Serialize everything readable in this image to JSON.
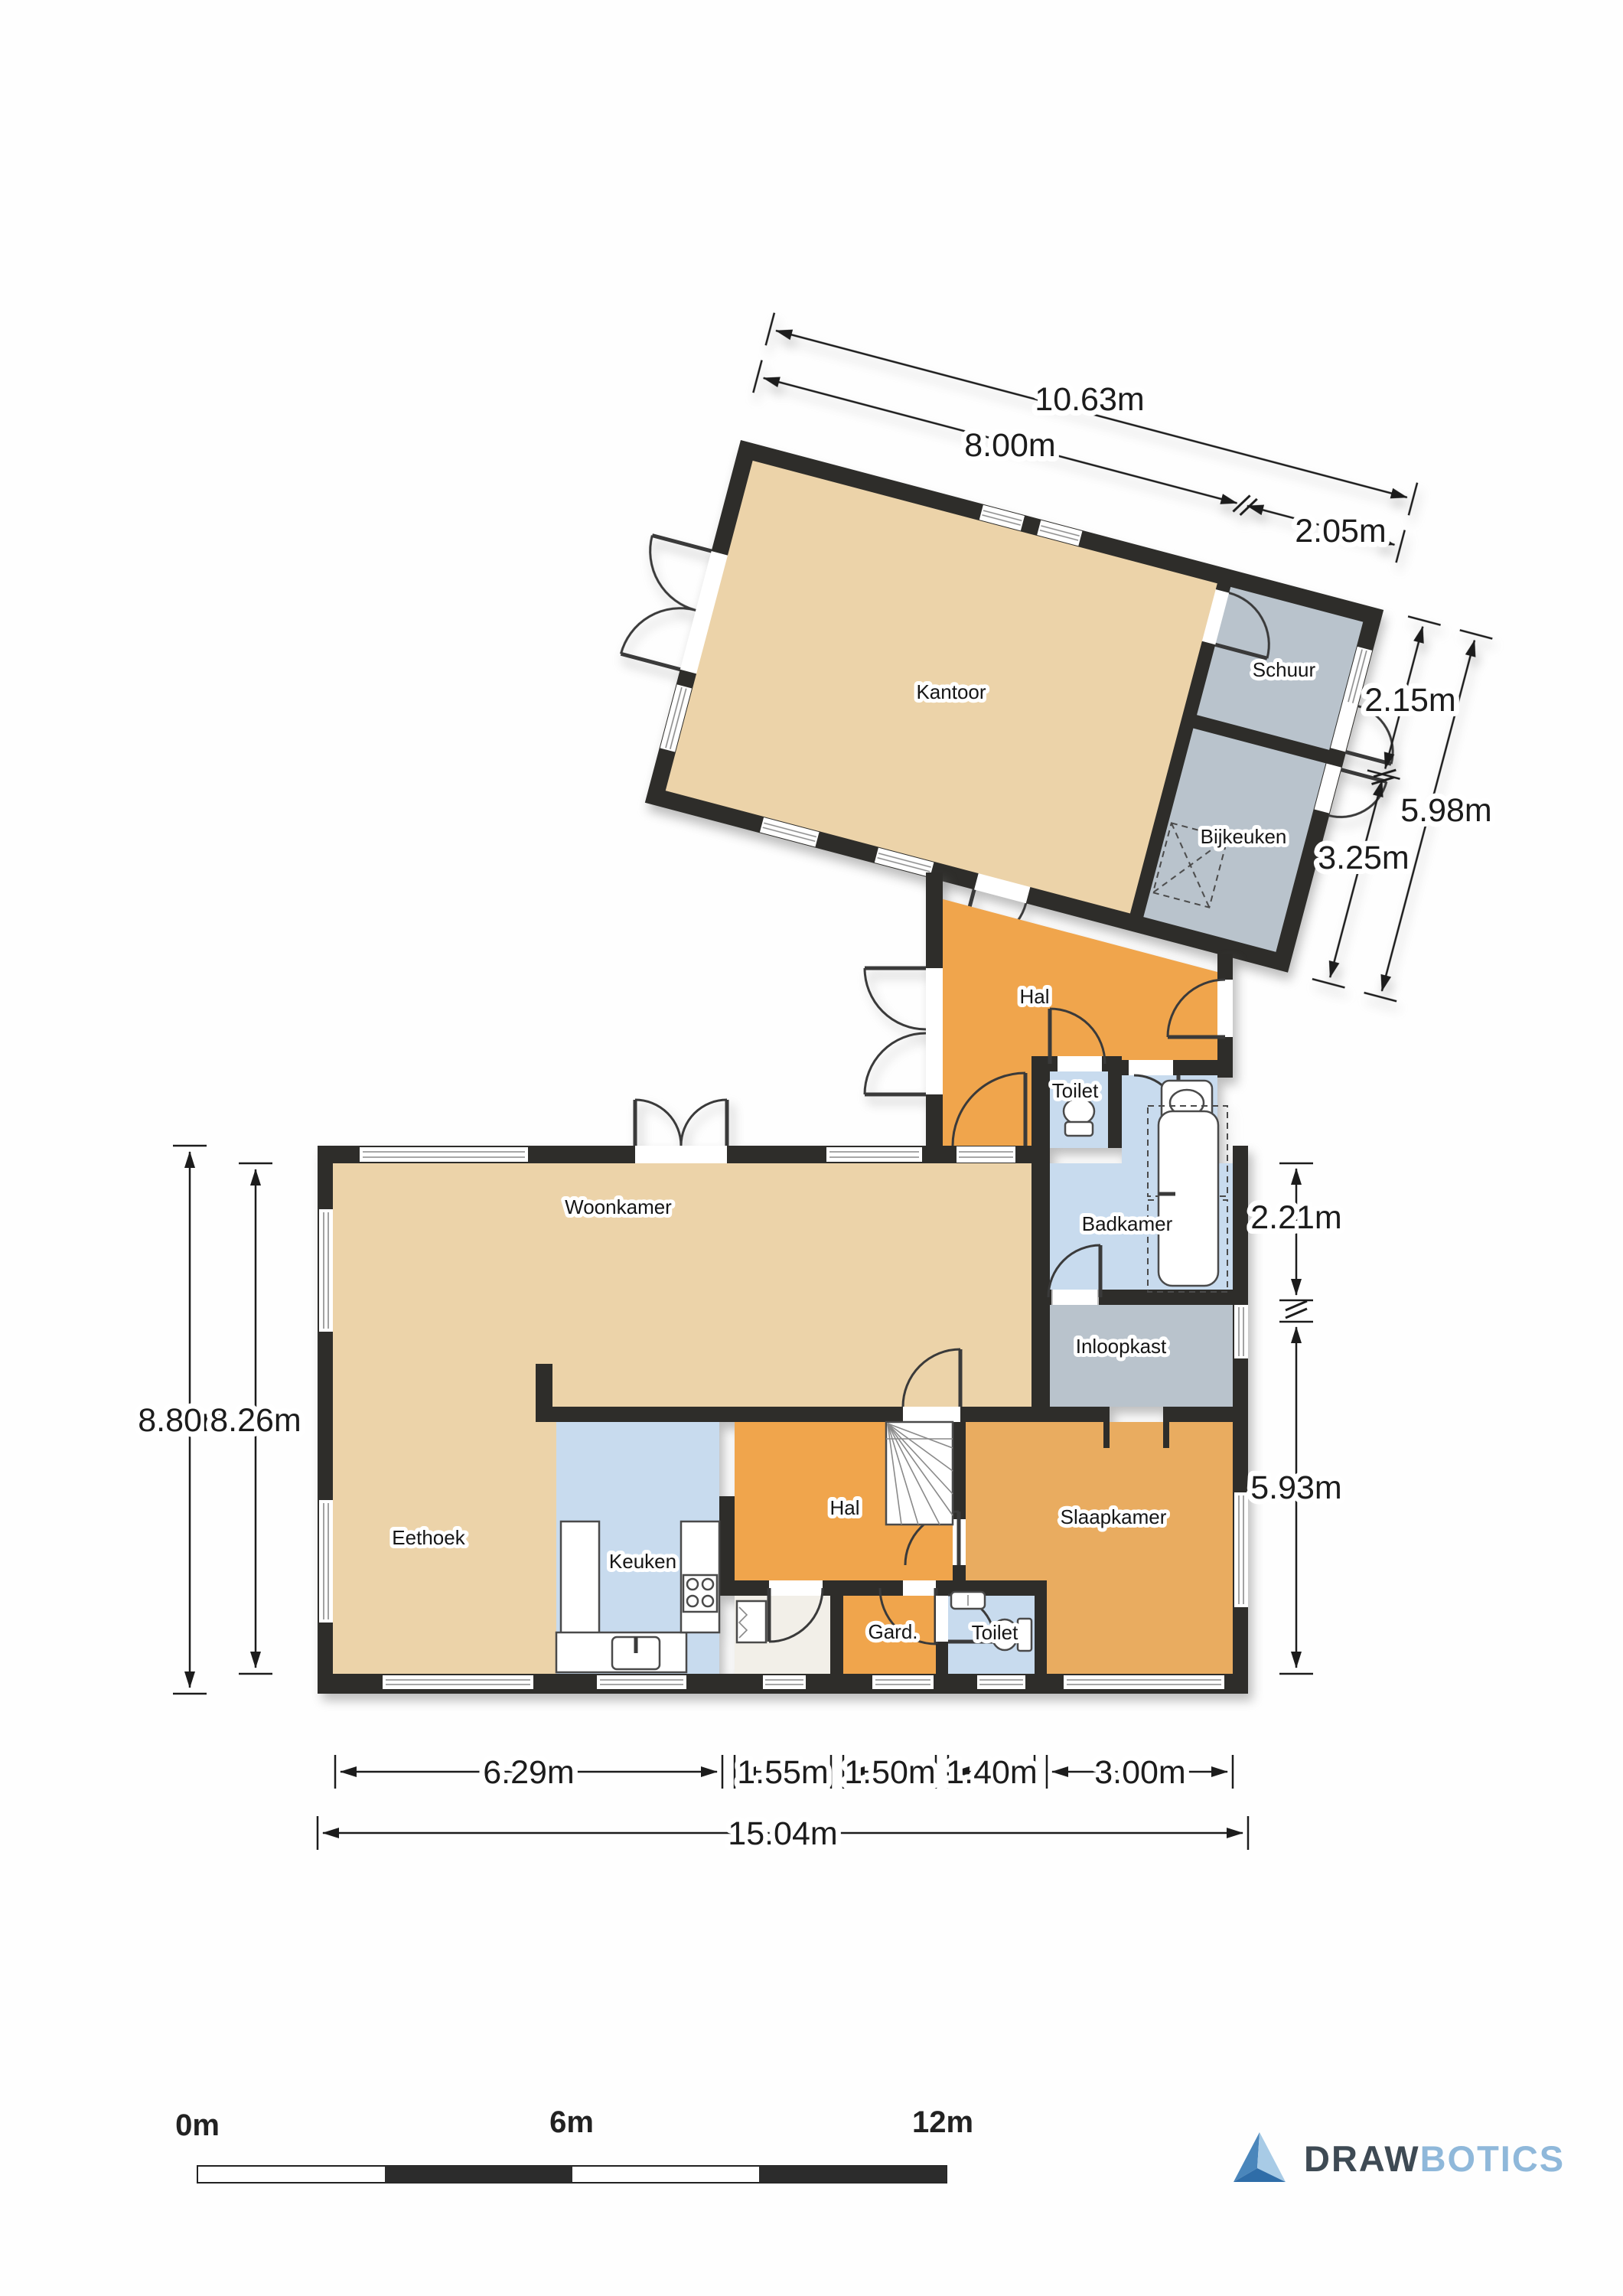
{
  "colors": {
    "wall": "#2e2d2a",
    "beige": "#ecd3a9",
    "gray": "#b9c3cc",
    "orange": "#f0a54c",
    "slaapkamer_tan": "#e9ac60",
    "blue": "#c8dbee",
    "closet_floor": "#f2efe8",
    "logo_dark": "#3e4a54",
    "logo_light": "#8fb8da"
  },
  "rooms": {
    "kantoor": {
      "label": "Kantoor"
    },
    "schuur": {
      "label": "Schuur"
    },
    "bijkeuken": {
      "label": "Bijkeuken"
    },
    "hal_boven": {
      "label": "Hal"
    },
    "toilet_boven": {
      "label": "Toilet"
    },
    "badkamer": {
      "label": "Badkamer"
    },
    "inloopkast": {
      "label": "Inloopkast"
    },
    "woonkamer": {
      "label": "Woonkamer"
    },
    "eethoek": {
      "label": "Eethoek"
    },
    "keuken": {
      "label": "Keuken"
    },
    "hal_beneden": {
      "label": "Hal"
    },
    "gard": {
      "label": "Gard."
    },
    "toilet_beneden": {
      "label": "Toilet"
    },
    "slaapkamer": {
      "label": "Slaapkamer"
    }
  },
  "dimensions": {
    "upper_top": [
      {
        "label": "10.63m"
      },
      {
        "label": "8.00m"
      },
      {
        "label": "2.05m"
      }
    ],
    "upper_right": [
      {
        "label": "2.15m"
      },
      {
        "label": "5.98m"
      },
      {
        "label": "3.25m"
      }
    ],
    "lower_left": [
      {
        "label": "8.80m"
      },
      {
        "label": "8.26m"
      }
    ],
    "lower_right": [
      {
        "label": "2.21m"
      },
      {
        "label": "5.93m"
      }
    ],
    "lower_bottom": [
      {
        "label": "6.29m"
      },
      {
        "label": "1.55m"
      },
      {
        "label": "1.50m"
      },
      {
        "label": "1.40m"
      },
      {
        "label": "3.00m"
      },
      {
        "label": "15.04m"
      }
    ]
  },
  "scale_bar": {
    "labels": [
      {
        "text": "0m"
      },
      {
        "text": "6m"
      },
      {
        "text": "12m"
      }
    ]
  },
  "logo": {
    "word_dark": "DRAW",
    "word_light": "BOTICS"
  }
}
